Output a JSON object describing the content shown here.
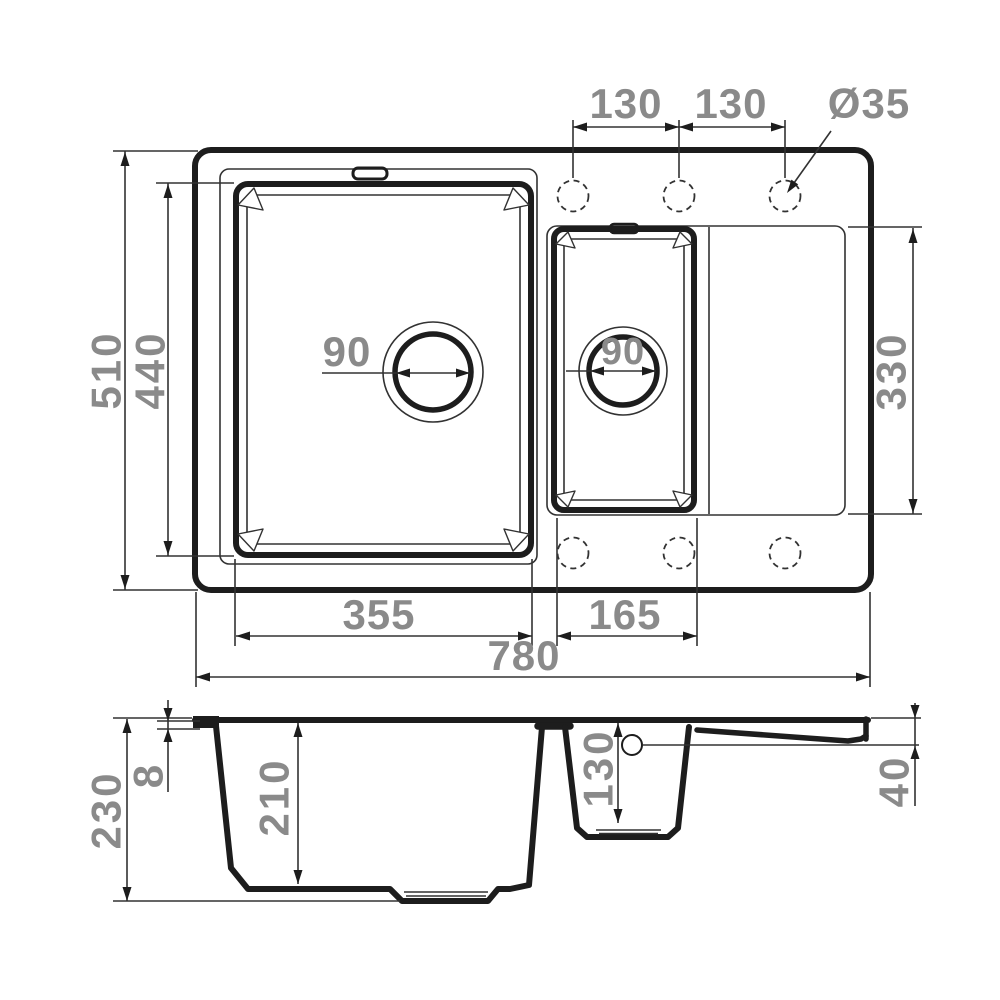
{
  "drawing_type": "kitchen sink technical dimension drawing",
  "colors": {
    "line": "#1d1d1d",
    "dimension_text": "#8a8a8a"
  },
  "top_view": {
    "tap_spacing_left_label": "130",
    "tap_spacing_right_label": "130",
    "tap_hole_diameter_label": "Ø35",
    "overall_depth_label": "510",
    "main_bowl_depth_label": "440",
    "main_drain_diameter_label": "90",
    "small_drain_diameter_label": "90",
    "drainboard_length_label": "330",
    "main_bowl_width_label": "355",
    "small_bowl_width_label": "165",
    "overall_width_label": "780"
  },
  "section_view": {
    "total_height_label": "230",
    "rim_thickness_label": "8",
    "main_bowl_depth_label": "210",
    "small_bowl_depth_label": "130",
    "drainboard_drop_label": "40"
  }
}
